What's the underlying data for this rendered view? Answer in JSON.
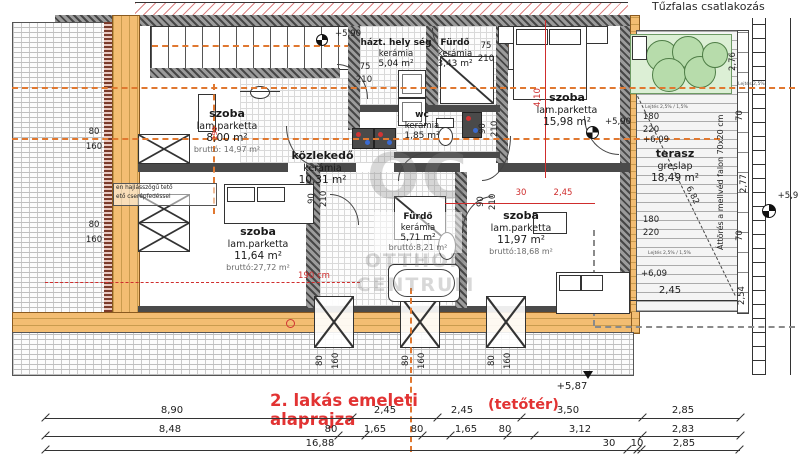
{
  "meta": {
    "plan_title": "2. lakás emeleti alaprajza",
    "plan_subtitle": "(tetőtér)"
  },
  "notes": {
    "top_right": "Tűzfalas csatlakozás",
    "parapet": "Áttörés a mellvéd falon 70x20 cm",
    "roof_line1": "en hajlásszögű tető",
    "roof_line2": "ető cserépfedéssel",
    "slope_a": "Lejtés 2,5% / 1,5%",
    "slope_b": "Lejtés 2,5% / 1,5%",
    "slope_c": "Lejtés 2,5%",
    "redline": "190 cm"
  },
  "watermark": {
    "abbr": "OC",
    "line1": "OTTHON",
    "line2": "CENTRUM"
  },
  "rooms": {
    "szoba_tl": {
      "name": "szoba",
      "floor": "lam.parketta",
      "area": "8,00 m²",
      "gross": "bruttó: 14,97 m²"
    },
    "kozlekedo": {
      "name": "közlekedő",
      "floor": "kerámia",
      "area": "10,31 m²"
    },
    "hazt": {
      "name": "házt. hely ség",
      "floor": "kerámia",
      "area": "5,04 m²"
    },
    "furdo_top": {
      "name": "Fürdő",
      "floor": "kerámia",
      "area": "3,43 m²"
    },
    "wc": {
      "name": "wc",
      "floor": "kerámia",
      "area": "1,85 m²"
    },
    "szoba_tr": {
      "name": "szoba",
      "floor": "lam.parketta",
      "area": "15,98 m²"
    },
    "terasz": {
      "name": "terasz",
      "floor": "greslap",
      "area": "18,49 m²"
    },
    "szoba_bl": {
      "name": "szoba",
      "floor": "lam.parketta",
      "area": "11,64 m²",
      "gross": "bruttó:27,72 m²"
    },
    "furdo_b": {
      "name": "Fürdő",
      "floor": "kerámia",
      "area": "5,71 m²",
      "gross": "bruttó:8,21 m²"
    },
    "szoba_br": {
      "name": "szoba",
      "floor": "lam.parketta",
      "area": "11,97 m²",
      "gross": "bruttó:18,68 m²"
    }
  },
  "levels": {
    "p590": "+5,90",
    "p59": "+5,9",
    "p609": "+6,09",
    "p587": "+5,87"
  },
  "dims": {
    "d75": "75",
    "d210": "210",
    "d90": "90",
    "d80": "80",
    "d160": "160",
    "d180": "180",
    "d220": "220",
    "d276": "2,76",
    "d277": "2,77",
    "d70": "70",
    "d254": "2,54",
    "d682": "6,82",
    "d410": "4,10",
    "d30": "30",
    "d245": "2,45",
    "d190": "190"
  },
  "dim_rows": {
    "row1": [
      "8,90",
      "2,45",
      "2,45",
      "3,50",
      "2,85"
    ],
    "row2": [
      "8,48",
      "80",
      "1,65",
      "80",
      "1,65",
      "80",
      "3,12",
      "2,83"
    ],
    "row3": [
      "16,88",
      "30",
      "10",
      "2,85"
    ]
  }
}
